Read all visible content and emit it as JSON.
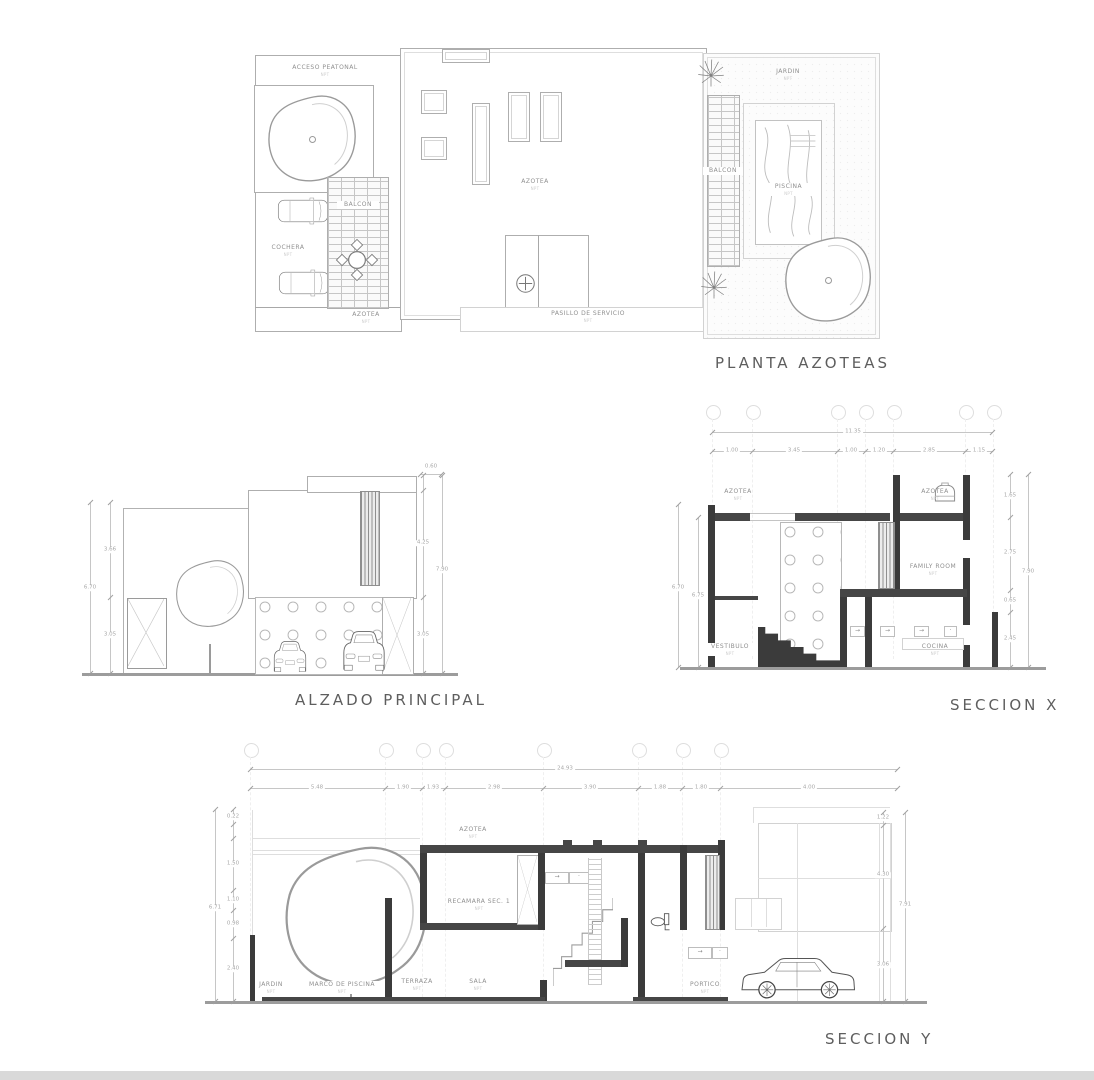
{
  "page": {
    "background": "#ffffff",
    "bottom_bar_color": "#d9d9d9"
  },
  "misc": {
    "arrow": "→",
    "dot": "·"
  },
  "drawings": {
    "planta": {
      "title": "PLANTA AZOTEAS",
      "level_note": "NPT",
      "labels": {
        "acceso_peatonal": "ACCESO PEATONAL",
        "cochera": "COCHERA",
        "balcon_izq": "BALCON",
        "azotea_principal": "AZOTEA",
        "azotea_cochera": "AZOTEA",
        "pasillo_servicio": "PASILLO DE SERVICIO",
        "jardin": "JARDIN",
        "balcon_der": "BALCON",
        "piscina": "PISCINA"
      }
    },
    "alzado": {
      "title": "ALZADO PRINCIPAL",
      "dims": {
        "left_total": "6.70",
        "left": [
          "3.66",
          "3.05"
        ],
        "right": [
          "0.60",
          "4.25",
          "3.05"
        ],
        "right_total": "7.90"
      }
    },
    "seccion_x": {
      "title": "SECCION X",
      "level_note": "NPT",
      "dims": {
        "top_total": "11.35",
        "top": [
          "1.00",
          "3.45",
          "1.00",
          "1.20",
          "2.85",
          "1.15"
        ],
        "right": [
          "1.65",
          "2.75",
          "0.65",
          "2.45"
        ],
        "right_total": "7.90",
        "left": [
          "6.70",
          "6.75"
        ]
      },
      "labels": {
        "azotea_izq": "AZOTEA",
        "azotea_der": "AZOTEA",
        "family_room": "FAMILY ROOM",
        "vestibulo": "VESTIBULO",
        "cocina": "COCINA"
      }
    },
    "seccion_y": {
      "title": "SECCION Y",
      "level_note": "NPT",
      "dims": {
        "top_total": "24.93",
        "top": [
          "5.48",
          "1.90",
          "1.93",
          "2.98",
          "3.90",
          "1.88",
          "1.80",
          "4.00"
        ],
        "left_total": "6.71",
        "left": [
          "0.22",
          "1.50",
          "1.10",
          "0.98",
          "2.40"
        ],
        "right": [
          "1.22",
          "4.30",
          "3.06"
        ],
        "right_total": "7.91"
      },
      "labels": {
        "azotea": "AZOTEA",
        "recamara": "RECAMARA SEC. 1",
        "jardin": "JARDIN",
        "marco_piscina": "MARCO DE PISCINA",
        "terraza": "TERRAZA",
        "sala": "SALA",
        "portico": "PORTICO"
      }
    }
  }
}
